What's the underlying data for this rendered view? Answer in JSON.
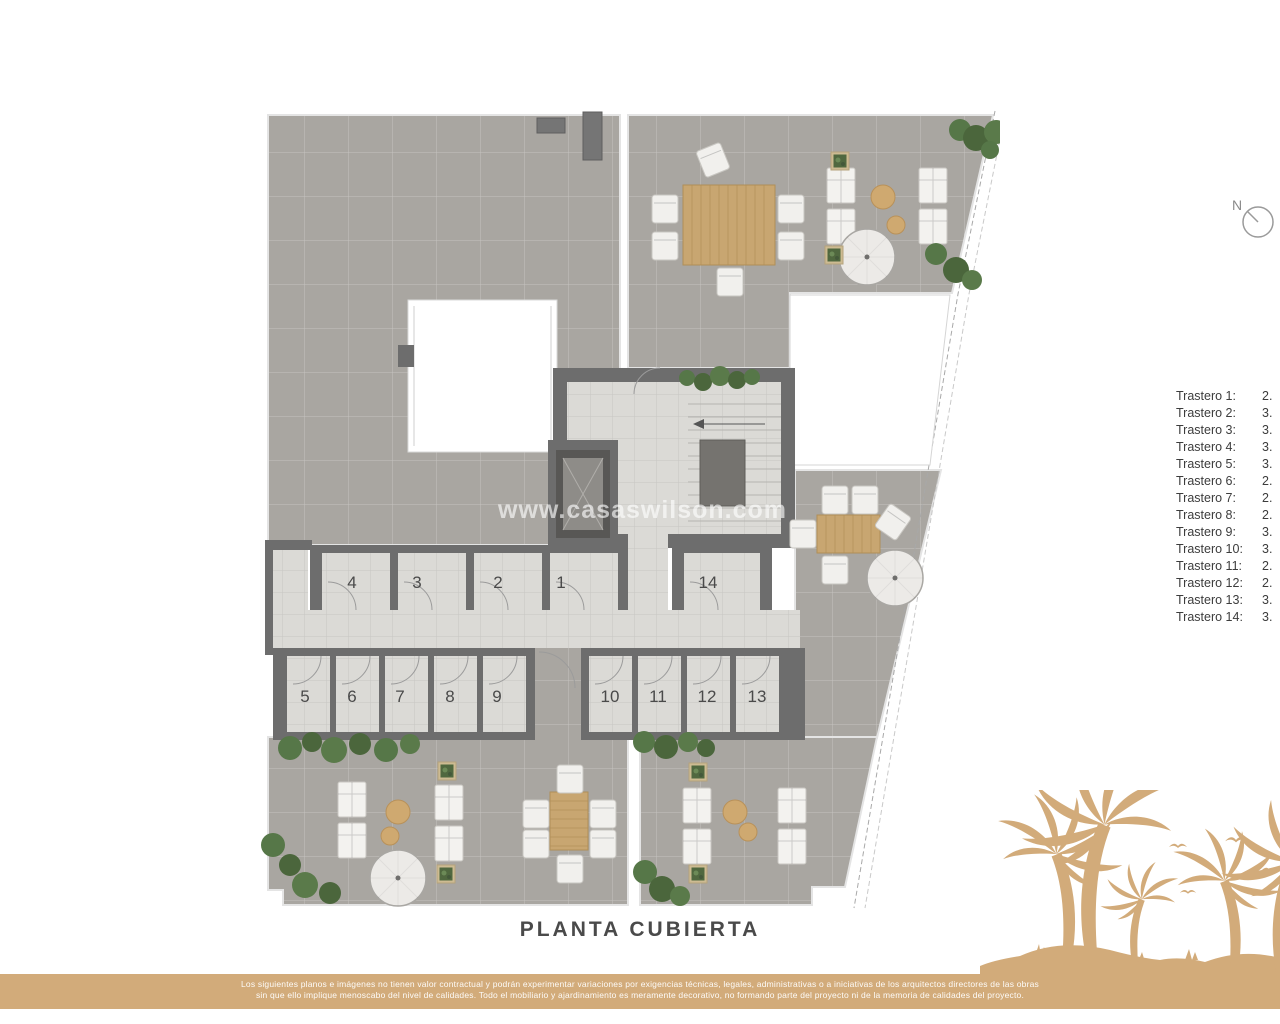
{
  "title": {
    "text": "PLANTA CUBIERTA"
  },
  "watermark": {
    "text": "www.casaswilson.com"
  },
  "north_indicator": {
    "label": "N"
  },
  "plan": {
    "name": "roof floor plan",
    "room_numbers": [
      "1",
      "2",
      "3",
      "4",
      "5",
      "6",
      "7",
      "8",
      "9",
      "10",
      "11",
      "12",
      "13",
      "14"
    ]
  },
  "legend": {
    "items": [
      {
        "label": "Trastero 1:",
        "value": "2."
      },
      {
        "label": "Trastero 2:",
        "value": "3."
      },
      {
        "label": "Trastero 3:",
        "value": "3."
      },
      {
        "label": "Trastero 4:",
        "value": "3."
      },
      {
        "label": "Trastero 5:",
        "value": "3."
      },
      {
        "label": "Trastero 6:",
        "value": "2."
      },
      {
        "label": "Trastero 7:",
        "value": "2."
      },
      {
        "label": "Trastero 8:",
        "value": "2."
      },
      {
        "label": "Trastero 9:",
        "value": "3."
      },
      {
        "label": "Trastero 10:",
        "value": "3."
      },
      {
        "label": "Trastero 11:",
        "value": "2."
      },
      {
        "label": "Trastero 12:",
        "value": "2."
      },
      {
        "label": "Trastero 13:",
        "value": "3."
      },
      {
        "label": "Trastero 14:",
        "value": "3."
      }
    ]
  },
  "footer": {
    "line1": "Los siguientes planos e imágenes no tienen valor contractual y podrán experimentar variaciones por exigencias técnicas, legales, administrativas o a iniciativas de los arquitectos directores de las obras",
    "line2": "sin que ello implique menoscabo del nivel de calidades. Todo el mobiliario y ajardinamiento es meramente decorativo, no formando parte del proyecto ni de la memoria de calidades del proyecto."
  },
  "colors": {
    "accent_tan": "#d2ab7a",
    "terrace_tile": "#a9a6a1",
    "interior_floor": "#dbdad6",
    "wall": "#6d6d6d",
    "wood": "#c8a671",
    "greenery": "#5a7a4a",
    "title_text": "#4a4a4a"
  }
}
